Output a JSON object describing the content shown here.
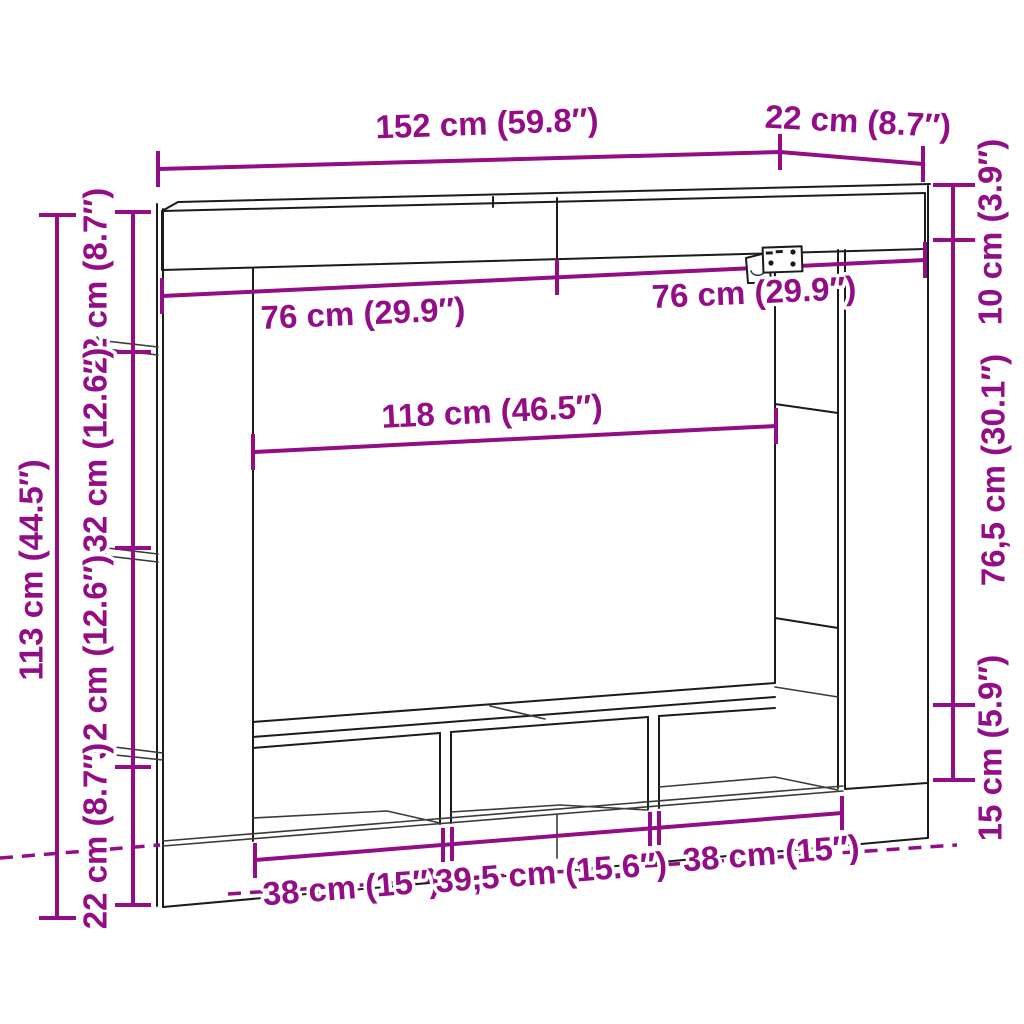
{
  "figure": {
    "kind": "furniture-dimension-diagram",
    "subject": "wall-mounted TV cabinet with side shelf columns and bottom cubby bench",
    "background": "#ffffff",
    "line_color": "#1b1b1b",
    "accent_color": "#920D86"
  },
  "labels": {
    "overall_width": "152 cm (59.8″)",
    "depth": "22 cm (8.7″)",
    "top_cabinet_height": "10 cm (3.9″)",
    "middle_opening_height": "76,5 cm (30.1″)",
    "bench_height": "15 cm (5.9″)",
    "overall_height": "113 cm (44.5″)",
    "left_segment_top": "22 cm (8.7″)",
    "left_segment_upper_mid": "32 cm (12.6″)",
    "left_segment_lower_mid": "32 cm (12.6″)",
    "left_segment_bottom": "22 cm (8.7″)",
    "top_compartment_left": "76 cm (29.9″)",
    "top_compartment_right": "76 cm (29.9″)",
    "opening_width": "118 cm (46.5″)",
    "cubby_left_width": "38 cm (15″)",
    "cubby_middle_width": "39,5 cm (15.6″)",
    "cubby_right_width": "38 cm (15″)"
  }
}
